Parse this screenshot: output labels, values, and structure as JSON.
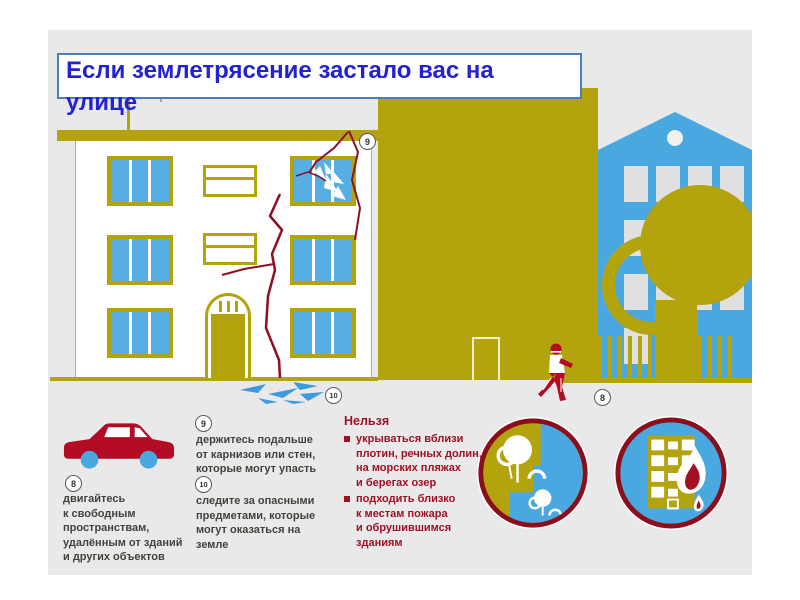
{
  "title": "Если землетрясение застало вас на улице",
  "instructions": [
    {
      "number": "8",
      "lines": [
        "двигайтесь",
        "к свободным",
        "пространствам,",
        "удалённым от зданий",
        "и других объектов"
      ]
    },
    {
      "number": "9",
      "lines": [
        "держитесь подальше",
        "от карнизов или стен,",
        "которые могут упасть"
      ]
    },
    {
      "number": "10",
      "lines": [
        "следите за опасными",
        "предметами, которые",
        "могут оказаться на",
        "земле"
      ]
    }
  ],
  "forbidden": {
    "header": "Нельзя",
    "items": [
      {
        "lines": [
          "укрываться вблизи",
          "плотин, речных долин,",
          "на морских пляжах",
          "и берегах озер"
        ]
      },
      {
        "lines": [
          "подходить близко",
          "к местам пожара",
          "и обрушившимся",
          "зданиям"
        ]
      }
    ]
  },
  "colors": {
    "olive": "#b3a40e",
    "blue": "#4aa8e0",
    "red": "#b30b24",
    "dark_red": "#9e1125",
    "crack_red": "#8d1022",
    "title_text": "#2121d6",
    "title_border": "#4a7ebb",
    "slide_background": "#e9e9e9",
    "body_text": "#44423c"
  },
  "icons": [
    "car-icon",
    "running-person-icon",
    "tree-icon",
    "tree-ring-icon",
    "park-safe-zone-icon",
    "burning-building-icon",
    "antenna-icon",
    "debris-icon",
    "broken-window-icon",
    "fence-icon"
  ]
}
